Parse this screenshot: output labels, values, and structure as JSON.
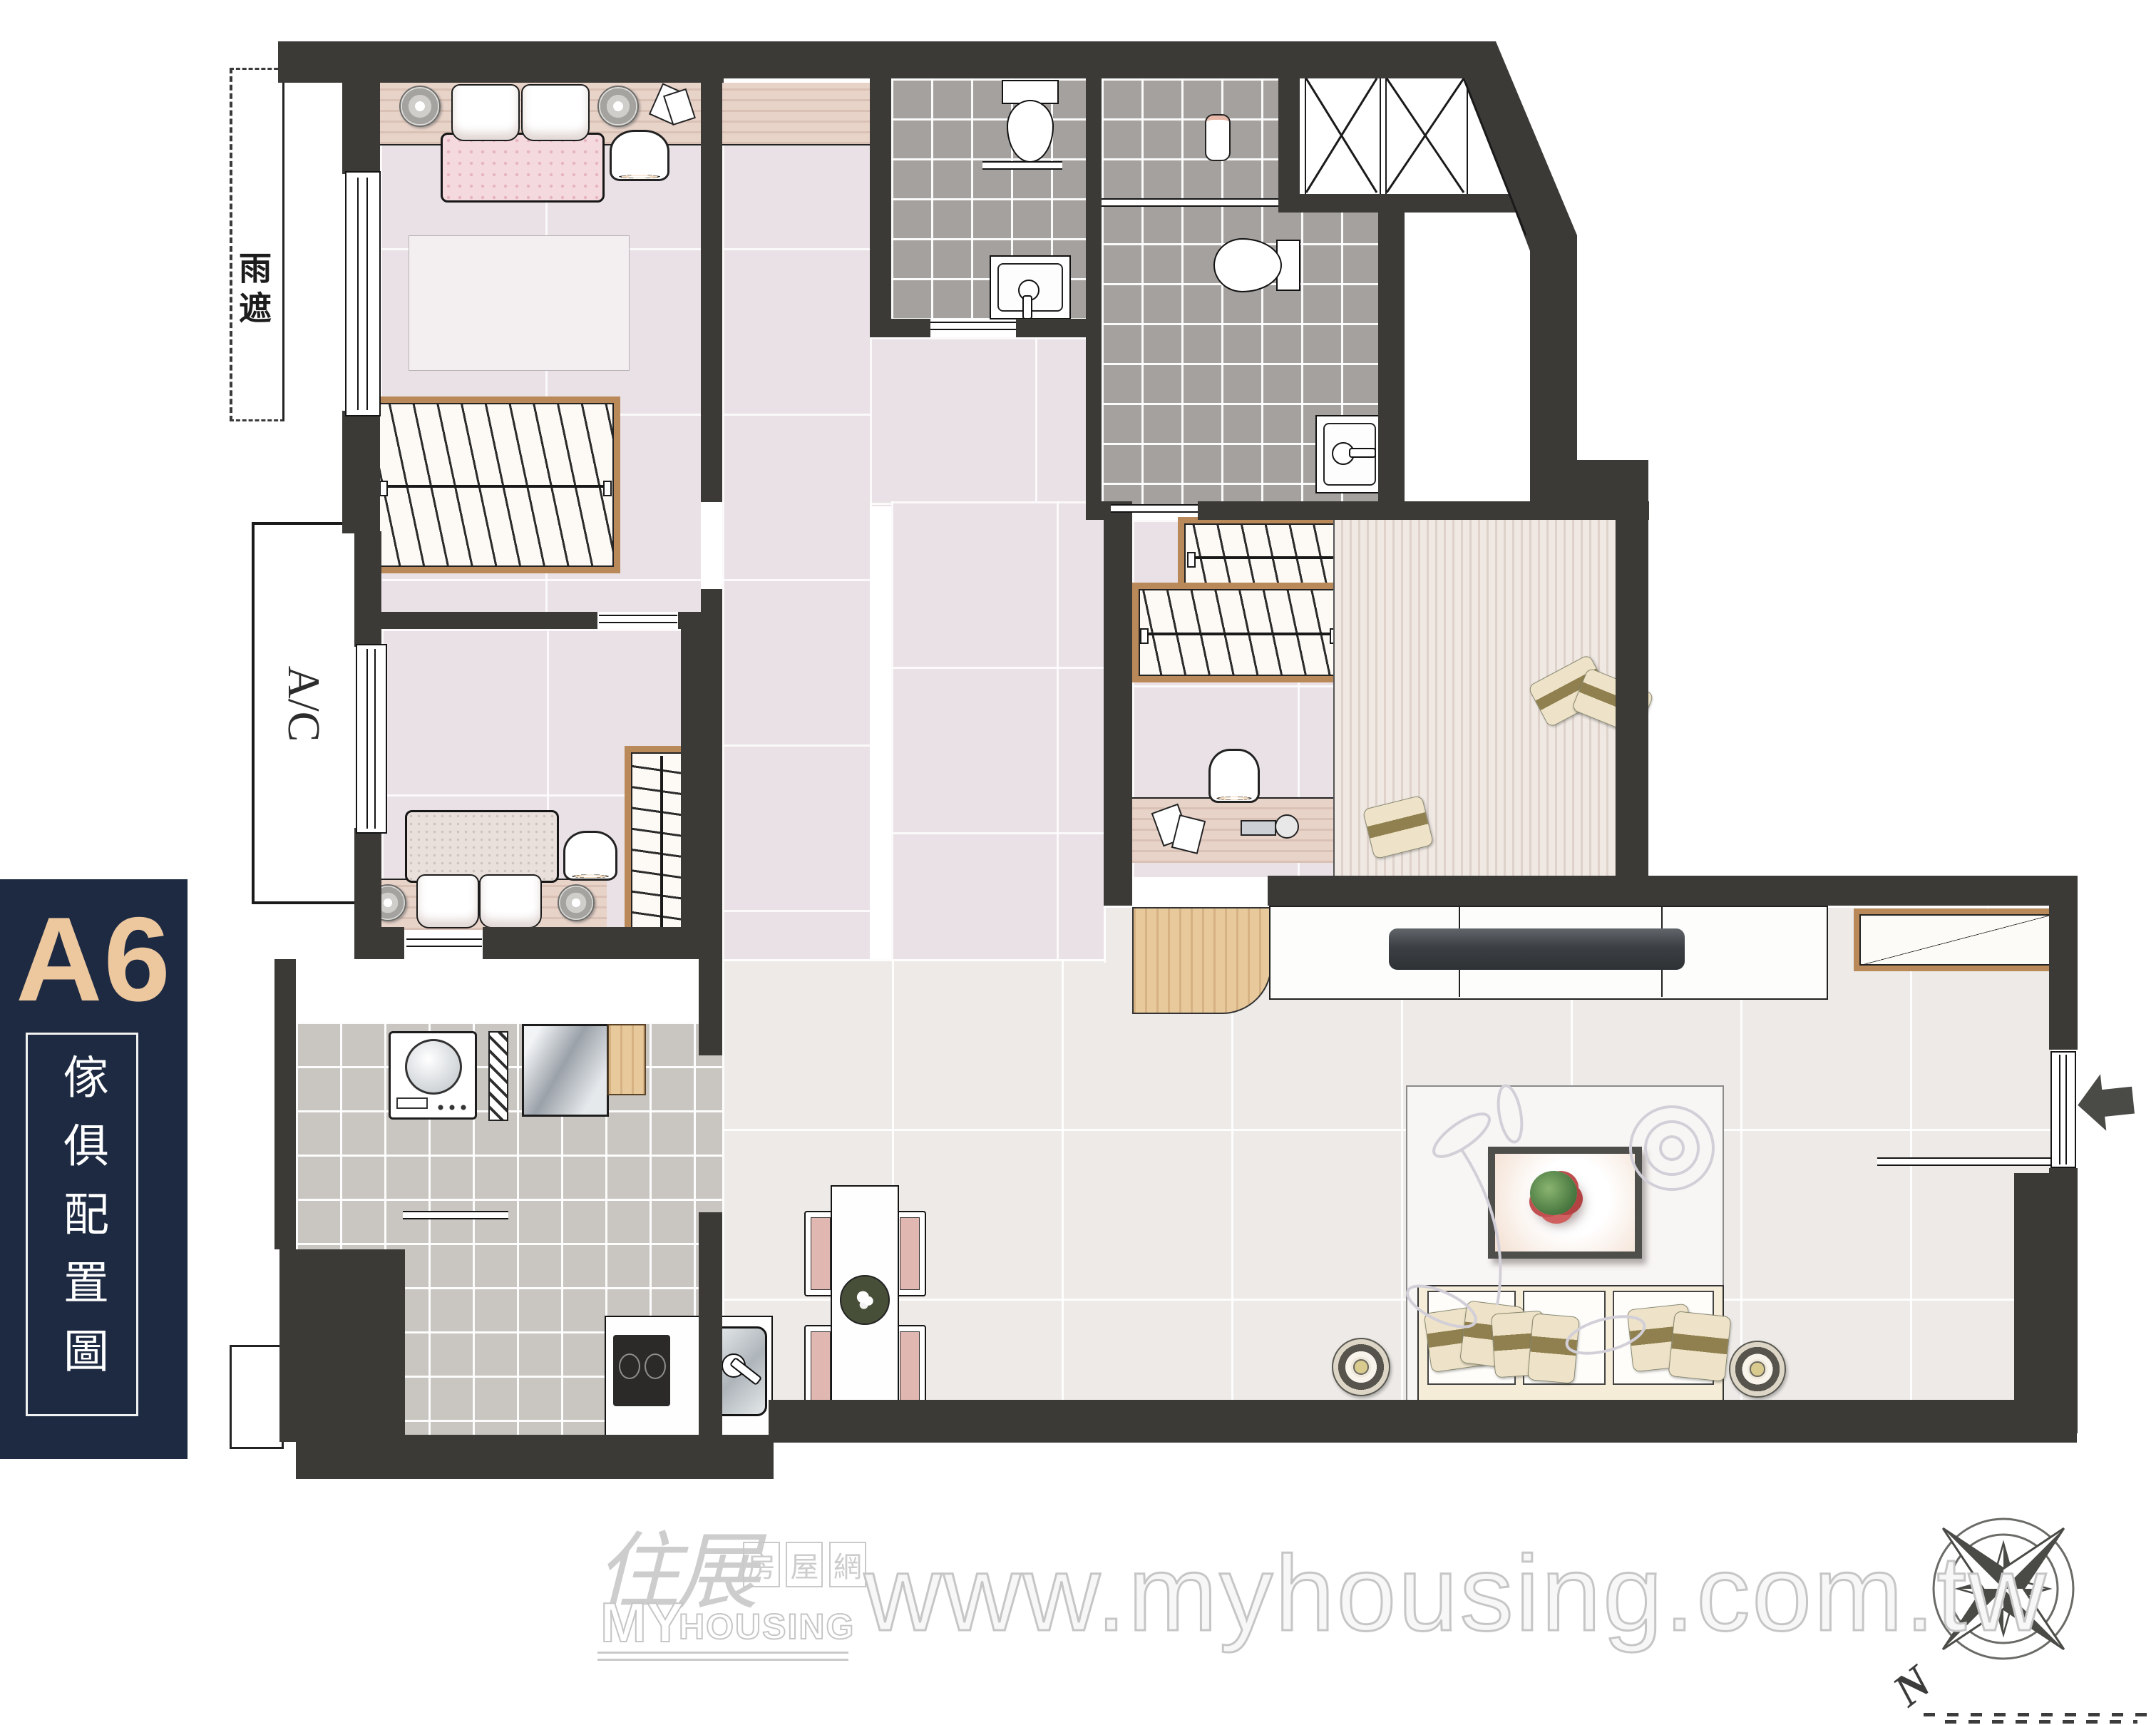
{
  "sidebar": {
    "unit_label": "A6",
    "unit_label_color": "#edc79e",
    "panel_color": "#1d2a42",
    "plan_type_title": "傢俱配置圖",
    "title_color": "#ffffff"
  },
  "plan": {
    "wall_color": "#3b3a37",
    "labels": {
      "rain_shelter": "雨遮",
      "air_conditioner": "A/C"
    },
    "floors": {
      "bedroom_tile": "#e9e1e5",
      "bathroom_tile": "#a5a19e",
      "utility_tile": "#c9c5c1",
      "living_tile": "#edeae7",
      "wood_accent": "#b9895a"
    },
    "rooms": [
      "master-bedroom",
      "second-bedroom",
      "study-bedroom",
      "bathroom-1",
      "bathroom-2",
      "utility-balcony",
      "kitchen",
      "dining-area",
      "living-room",
      "entry",
      "ac-balcony",
      "rain-shelter"
    ],
    "furniture": [
      "double-bed",
      "single-bed",
      "platform-bed",
      "wardrobe",
      "closet",
      "desk",
      "desk-lamp",
      "bedside-lamp",
      "washing-machine",
      "refrigerator",
      "stove",
      "kitchen-sink",
      "dining-table",
      "dining-chair",
      "sofa",
      "coffee-table",
      "plant",
      "tv",
      "tv-console",
      "shoe-cabinet",
      "toilet",
      "bathroom-sink",
      "rug",
      "speaker-lamp",
      "entry-arrow",
      "pipe-shaft"
    ]
  },
  "watermark": {
    "url_text": "www.myhousing.com.tw",
    "logo": {
      "brand_cjk": "住展",
      "site_cjk_chars": [
        "房",
        "屋",
        "網"
      ],
      "brand_en_1": "MY",
      "brand_en_2": "HOUSING"
    },
    "color": "#c9c9c9"
  },
  "compass": {
    "north_label": "N"
  }
}
